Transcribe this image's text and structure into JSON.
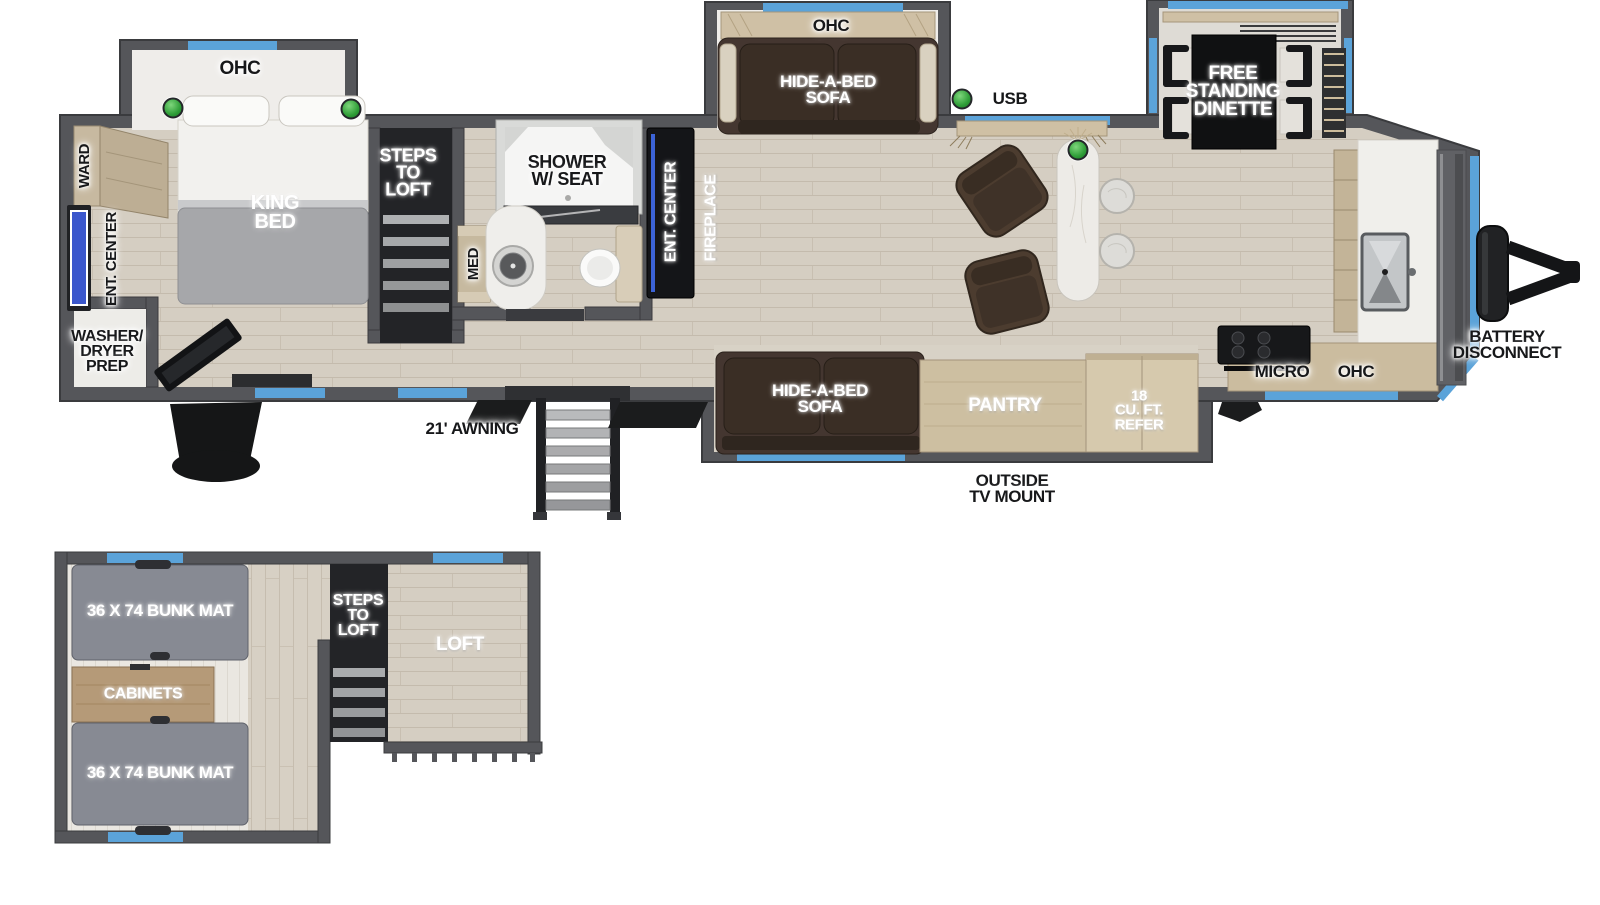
{
  "colors": {
    "wall": "#55565a",
    "wall_dark": "#3a3b3e",
    "window_blue": "#5ba3d9",
    "floor_wood": "#d5cec2",
    "slide_interior": "#efedea",
    "sofa_brown": "#443630",
    "mattress_gray": "#a6a7aa",
    "cabinet_wood": "#cdbfa1",
    "table_black": "#101112",
    "usb_green": "#3fae47",
    "tv_blue": "#3b57cc"
  },
  "main_floor": {
    "bedroom": {
      "slide_ohc_label": "OHC",
      "bed_label": "KING\nBED",
      "ward_label": "WARD",
      "ent_center_label": "ENT. CENTER",
      "washer_dryer_label": "WASHER/\nDRYER\nPREP"
    },
    "stairs": {
      "label": "STEPS\nTO\nLOFT"
    },
    "bathroom": {
      "shower_label": "SHOWER\nW/ SEAT",
      "med_label": "MED"
    },
    "living": {
      "ent_center_label": "ENT. CENTER",
      "fireplace_label": "FIREPLACE",
      "sofa_slide_ohc_label": "OHC",
      "sofa_top_label": "HIDE-A-BED\nSOFA",
      "sofa_bottom_label": "HIDE-A-BED\nSOFA",
      "usb_label": "USB",
      "dinette_label": "FREE\nSTANDING\nDINETTE"
    },
    "kitchen": {
      "micro_label": "MICRO",
      "ohc_label": "OHC",
      "pantry_label": "PANTRY",
      "refer_label": "18\nCU. FT.\nREFER"
    },
    "exterior": {
      "awning_label": "21' AWNING",
      "outside_tv_label": "OUTSIDE\nTV MOUNT",
      "battery_label": "BATTERY\nDISCONNECT"
    }
  },
  "loft_floor": {
    "bunk1_label": "36 X 74 BUNK MAT",
    "cabinets_label": "CABINETS",
    "bunk2_label": "36 X 74 BUNK MAT",
    "steps_label": "STEPS\nTO\nLOFT",
    "loft_label": "LOFT"
  }
}
